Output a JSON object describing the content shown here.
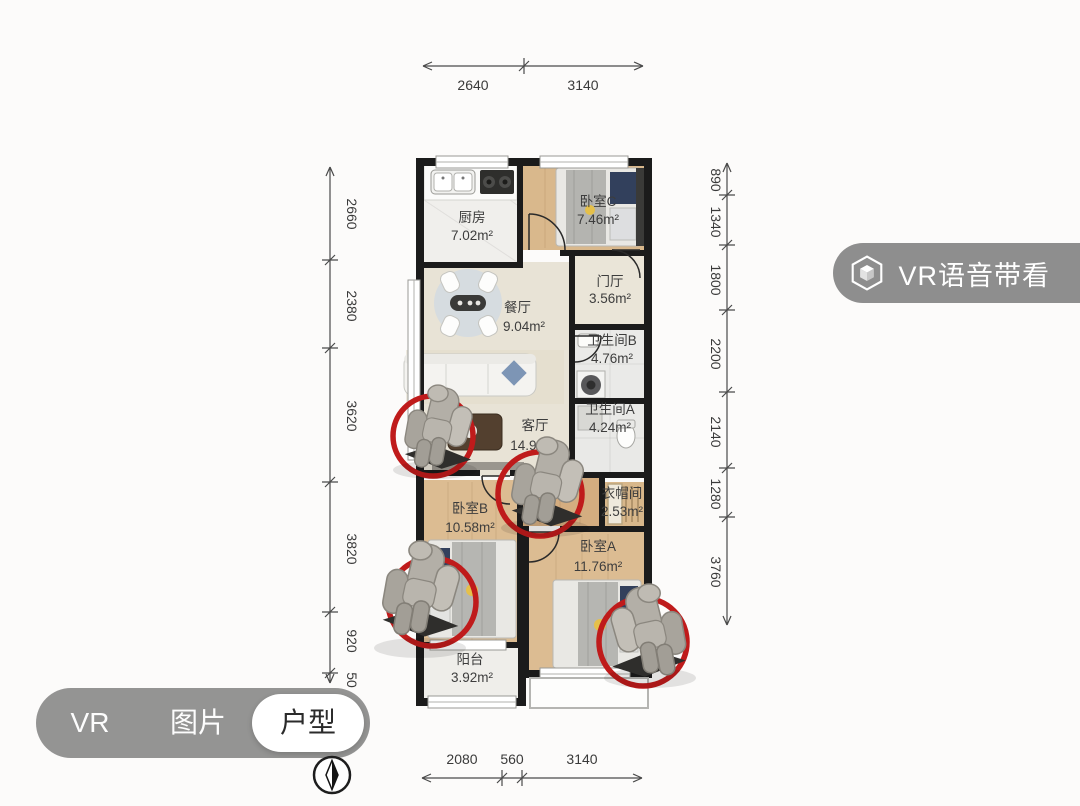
{
  "floor_plan": {
    "rooms": [
      {
        "id": "kitchen",
        "name": "厨房",
        "area": "7.02m²"
      },
      {
        "id": "bedroom-c",
        "name": "卧室C",
        "area": "7.46m²"
      },
      {
        "id": "entry-hall",
        "name": "门厅",
        "area": "3.56m²"
      },
      {
        "id": "dining-room",
        "name": "餐厅",
        "area": "9.04m²"
      },
      {
        "id": "bathroom-b",
        "name": "卫生间B",
        "area": "4.76m²"
      },
      {
        "id": "living-room",
        "name": "客厅",
        "area": "14.94m²"
      },
      {
        "id": "bathroom-a",
        "name": "卫生间A",
        "area": "4.24m²"
      },
      {
        "id": "cloakroom",
        "name": "衣帽间",
        "area": "2.53m²"
      },
      {
        "id": "bedroom-b",
        "name": "卧室B",
        "area": "10.58m²"
      },
      {
        "id": "bedroom-a",
        "name": "卧室A",
        "area": "11.76m²"
      },
      {
        "id": "balcony",
        "name": "阳台",
        "area": "3.92m²"
      }
    ],
    "dimensions": {
      "top": [
        "2640",
        "3140"
      ],
      "bottom": [
        "2080",
        "560",
        "3140"
      ],
      "left": [
        "2660",
        "2380",
        "3620",
        "3820",
        "920",
        "50"
      ],
      "right": [
        "890",
        "1340",
        "1800",
        "2200",
        "2140",
        "1280",
        "3760"
      ]
    }
  },
  "overlay": {
    "vr_voice_button": {
      "label": "VR语音带看",
      "icon": "hexagon-cube-icon"
    },
    "tabs": [
      {
        "label": "VR",
        "active": false
      },
      {
        "label": "图片",
        "active": false
      },
      {
        "label": "户型",
        "active": true
      }
    ],
    "compass_icon": "north-compass-icon"
  },
  "colors": {
    "highlight_red": "#bf1b1b",
    "pill_gray": "rgba(122,122,122,0.85)",
    "wall_black": "#1b1b1b",
    "wood_floor": "#d9b88c"
  }
}
